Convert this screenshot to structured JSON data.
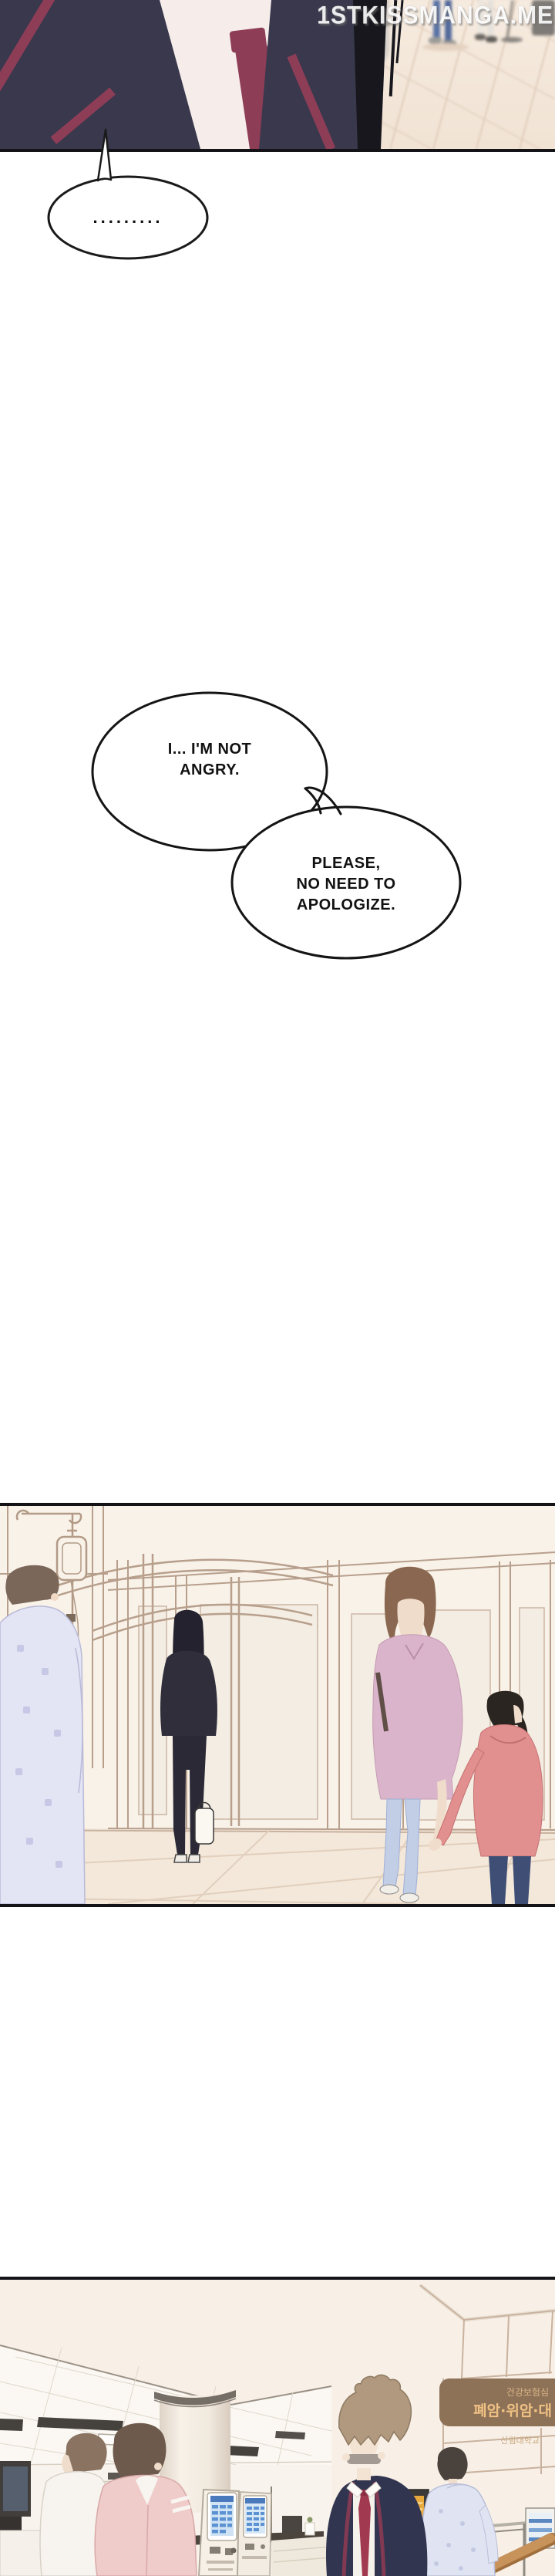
{
  "watermark": {
    "text": "1STKISSMANGA.ME"
  },
  "speech_bubbles": {
    "silence": {
      "text": "........."
    },
    "not_angry": {
      "line1": "I... I'M NOT",
      "line2": "ANGRY."
    },
    "apologize": {
      "line1": "PLEASE,",
      "line2": "NO NEED TO",
      "line3": "APOLOGIZE."
    }
  },
  "hospital_lobby": {
    "sign": {
      "line1": "건강보험심",
      "line2": "폐암·위암·대"
    },
    "wall_text": "산림대학교"
  },
  "colors": {
    "uniform_navy": "#39384c",
    "uniform_trim_maroon": "#8e3d57",
    "tie_red": "#a13a50",
    "hair_black": "#17171d",
    "floor_beige": "#f3e6d9",
    "wall_cream": "#f9f2e9",
    "frame_tan": "#b79f8c",
    "pajama_lavender": "#e1e2f2",
    "sweater_mauve": "#dab4ca",
    "hoodie_coral": "#e28f8f",
    "jeans_blue": "#c2cde6",
    "sign_brown": "#8e7258",
    "sign_text_gold": "#efc183",
    "kiosk_screen_blue": "#cfe3f4",
    "handrail_wood": "#c8935a"
  }
}
